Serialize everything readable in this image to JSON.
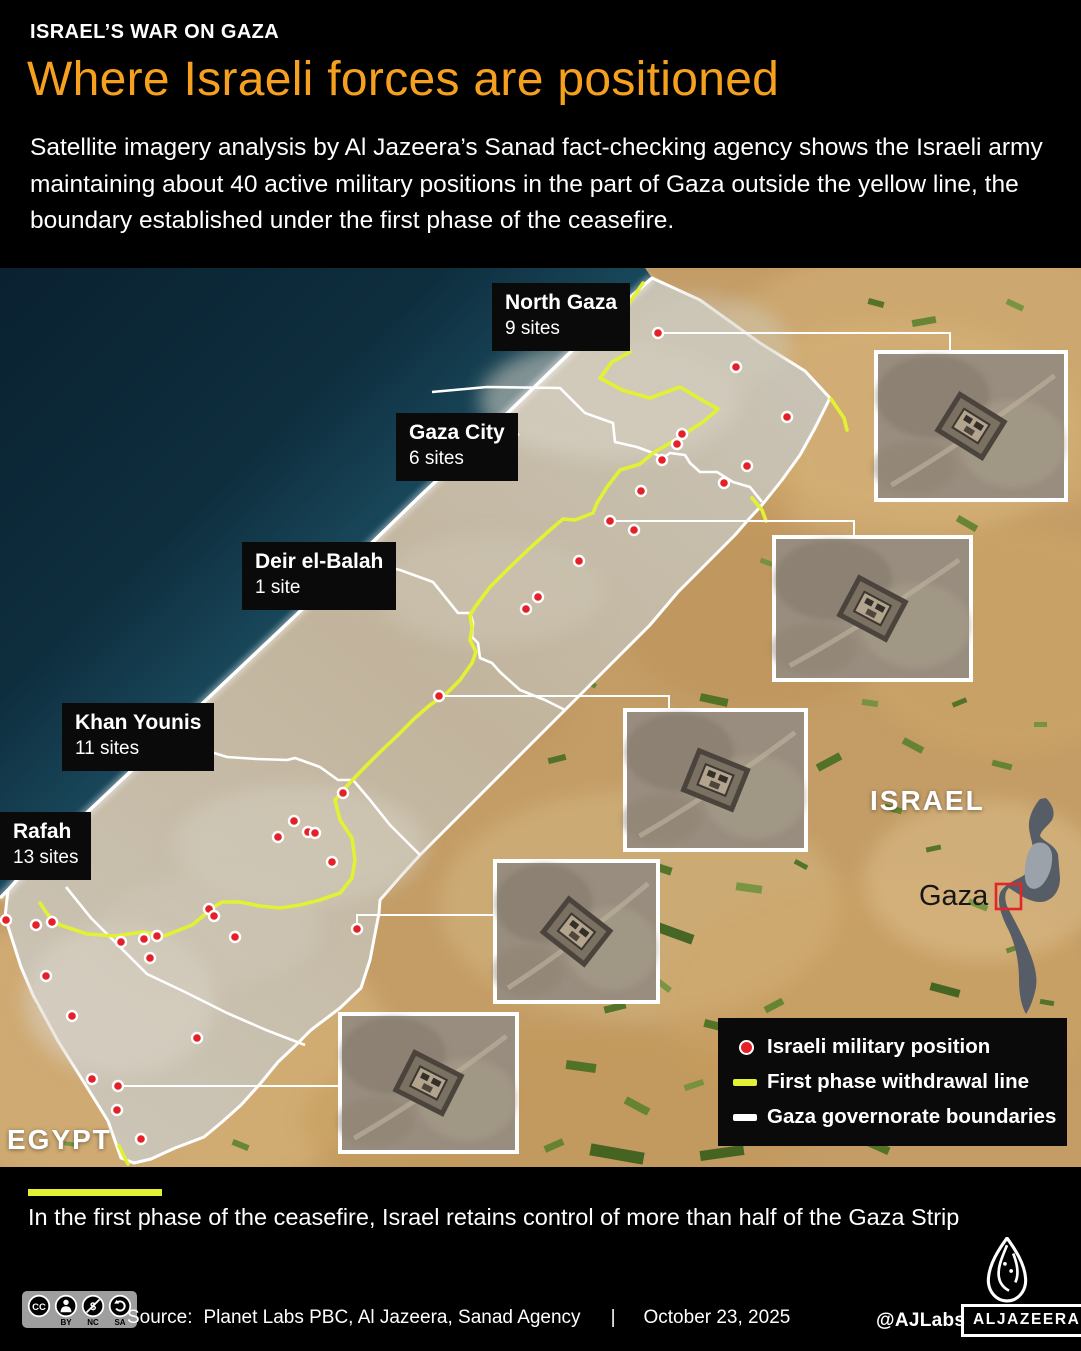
{
  "header": {
    "kicker": "ISRAEL’S WAR ON GAZA",
    "title": "Where Israeli forces are positioned",
    "description": "Satellite imagery analysis by Al Jazeera’s Sanad fact-checking agency shows the Israeli army maintaining about 40 active military positions in the part of Gaza outside the yellow line, the boundary established under the first phase of the ceasefire."
  },
  "map": {
    "governorates": [
      {
        "name": "North Gaza",
        "sites": "9 sites"
      },
      {
        "name": "Gaza City",
        "sites": "6 sites"
      },
      {
        "name": "Deir el-Balah",
        "sites": "1 site"
      },
      {
        "name": "Khan Younis",
        "sites": "11 sites"
      },
      {
        "name": "Rafah",
        "sites": "13 sites"
      }
    ],
    "region_labels": {
      "israel": "ISRAEL",
      "egypt": "EGYPT",
      "inset_gaza": "Gaza"
    },
    "legend": [
      {
        "type": "dot",
        "label": "Israeli military position"
      },
      {
        "type": "yellow-line",
        "label": "First phase withdrawal line"
      },
      {
        "type": "white-line",
        "label": "Gaza governorate boundaries"
      }
    ],
    "colors": {
      "position_dot": "#e52028",
      "withdrawal_line": "#e3f135",
      "boundary_line": "#ffffff"
    },
    "military_positions": [
      [
        623,
        322
      ],
      [
        658,
        333
      ],
      [
        736,
        367
      ],
      [
        787,
        417
      ],
      [
        682,
        434
      ],
      [
        677,
        444
      ],
      [
        662,
        460
      ],
      [
        747,
        466
      ],
      [
        724,
        483
      ],
      [
        641,
        491
      ],
      [
        610,
        521
      ],
      [
        634,
        530
      ],
      [
        579,
        561
      ],
      [
        538,
        597
      ],
      [
        526,
        609
      ],
      [
        439,
        696
      ],
      [
        343,
        793
      ],
      [
        294,
        821
      ],
      [
        308,
        832
      ],
      [
        315,
        833
      ],
      [
        278,
        837
      ],
      [
        332,
        862
      ],
      [
        209,
        909
      ],
      [
        214,
        916
      ],
      [
        235,
        937
      ],
      [
        357,
        929
      ],
      [
        197,
        1038
      ],
      [
        6,
        920
      ],
      [
        36,
        925
      ],
      [
        52,
        922
      ],
      [
        121,
        942
      ],
      [
        144,
        939
      ],
      [
        157,
        936
      ],
      [
        150,
        958
      ],
      [
        46,
        976
      ],
      [
        72,
        1016
      ],
      [
        92,
        1079
      ],
      [
        118,
        1086
      ],
      [
        117,
        1110
      ],
      [
        141,
        1139
      ]
    ]
  },
  "footnote": "In the first phase of the ceasefire, Israel retains control of more than half of the Gaza Strip",
  "footer": {
    "source_label": "Source:",
    "source": "Planet Labs PBC, Al Jazeera, Sanad Agency",
    "separator": "|",
    "date": "October 23, 2025",
    "handle": "@AJLabs",
    "logo_text": "ALJAZEERA",
    "cc_labels": [
      "BY",
      "NC",
      "SA"
    ]
  }
}
